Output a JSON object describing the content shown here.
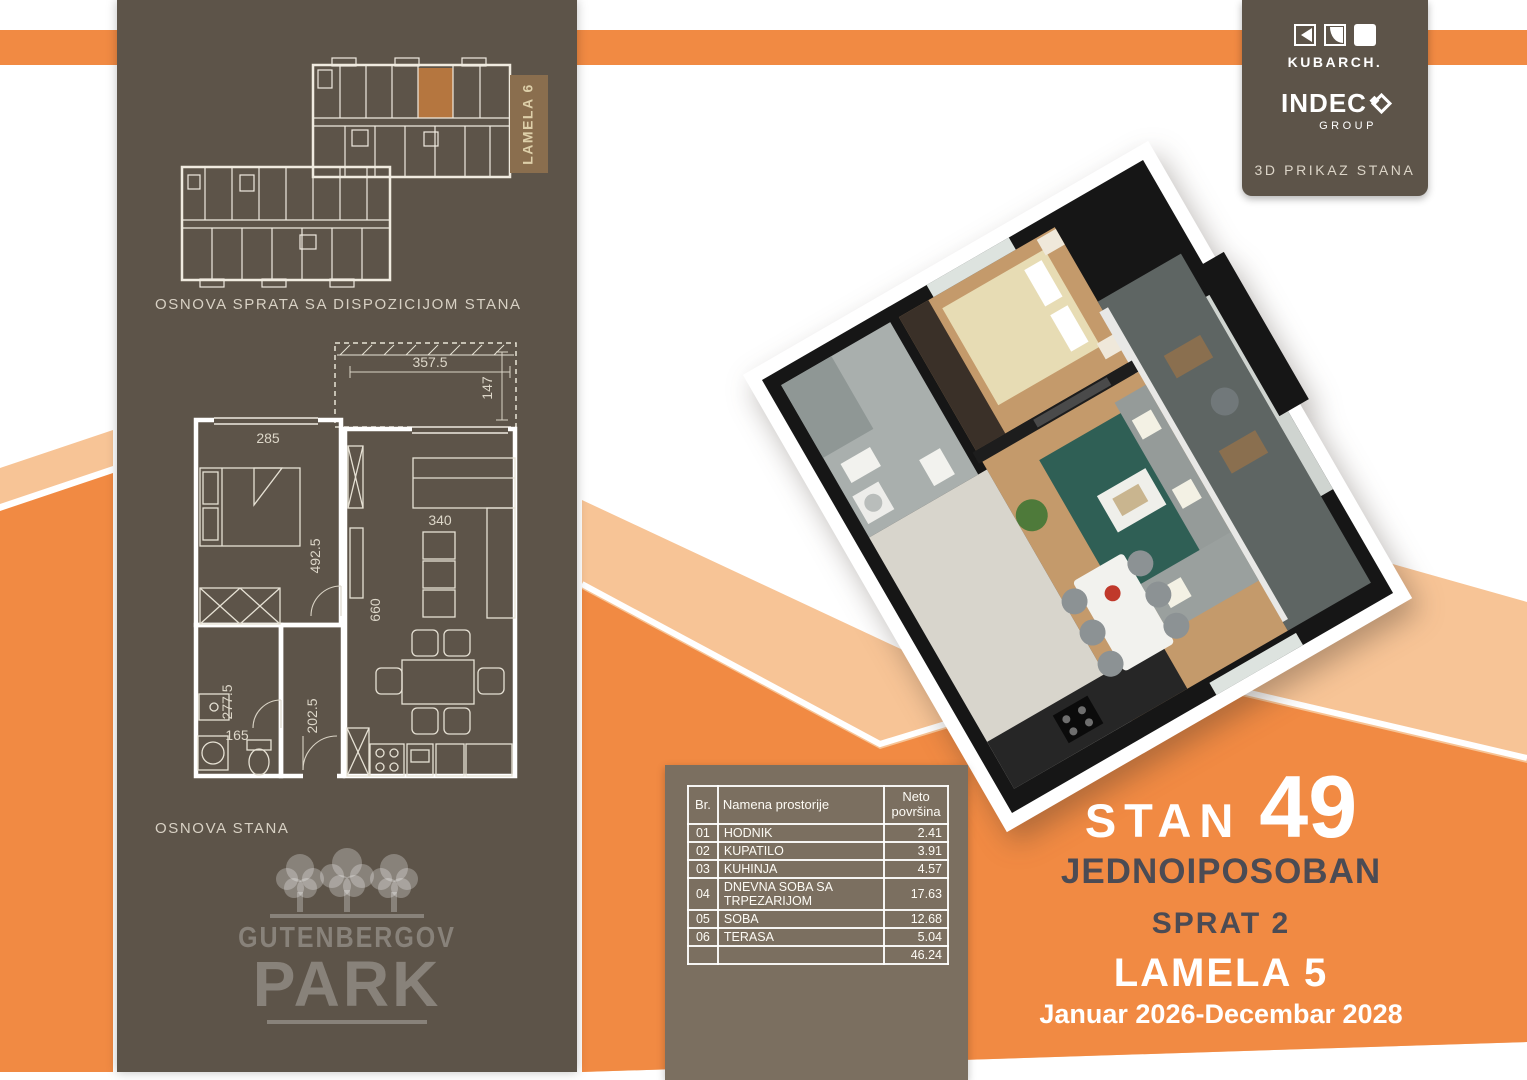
{
  "brand_panel": {
    "kubarch_label": "KUBARCH.",
    "indeco_label": "INDEC",
    "indeco_group": "GROUP",
    "caption": "3D PRIKAZ STANA"
  },
  "left_panel": {
    "lamela_tag": "LAMELA 6",
    "site_plan_title": "OSNOVA SPRATA SA DISPOZICIJOM STANA",
    "unit_plan_title": "OSNOVA STANA",
    "logo_top": "GUTENBERGOV",
    "logo_bottom": "PARK"
  },
  "plan_dims": {
    "terrace_w": "357.5",
    "terrace_h": "147",
    "bedroom_w": "285",
    "bedroom_h": "492.5",
    "sofa_w": "340",
    "living_h": "660",
    "bath_h": "277.5",
    "hall_h": "202.5",
    "bath_w": "165"
  },
  "table": {
    "col_br": "Br.",
    "col_name": "Namena prostorije",
    "col_area_line1": "Neto",
    "col_area_line2": "površina",
    "rows": [
      {
        "br": "01",
        "name": "HODNIK",
        "area": "2.41"
      },
      {
        "br": "02",
        "name": "KUPATILO",
        "area": "3.91"
      },
      {
        "br": "03",
        "name": "KUHINJA",
        "area": "4.57"
      },
      {
        "br": "04",
        "name": "DNEVNA SOBA SA TRPEZARIJOM",
        "area": "17.63"
      },
      {
        "br": "05",
        "name": "SOBA",
        "area": "12.68"
      },
      {
        "br": "06",
        "name": "TERASA",
        "area": "5.04"
      }
    ],
    "total": "46.24"
  },
  "info": {
    "stan": "STAN",
    "number": "49",
    "type": "JEDNOIPOSOBAN",
    "floor": "SPRAT 2",
    "lamela": "LAMELA 5",
    "period": "Januar 2026-Decembar 2028"
  },
  "colors": {
    "orange": "#F18A43",
    "peach": "#F7C496",
    "brown_panel": "#5D5449",
    "table_panel": "#7B6F60",
    "lamela_box": "#8A6E4E",
    "unit_highlight": "#B5763F",
    "dark_text": "#4B4B54"
  }
}
